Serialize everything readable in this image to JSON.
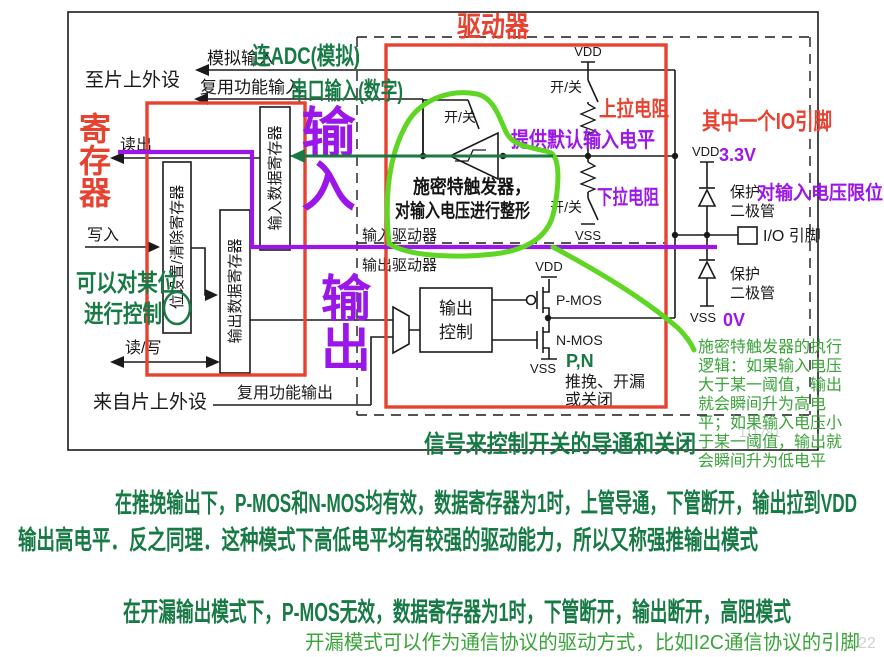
{
  "diagram": {
    "left": {
      "to_chip": "至片上外设",
      "from_chip": "来自片上外设",
      "read": "读出",
      "write": "写入",
      "read_write": "读/写"
    },
    "signals": {
      "analog_in": "模拟输入",
      "af_in": "复用功能输入",
      "af_out": "复用功能输出"
    },
    "registers": {
      "bit_set_clear": "位设置/清除寄存器",
      "output_data": "输出数据寄存器",
      "input_data": "输入数据寄存器"
    },
    "driver": {
      "input_driver": "输入驱动器",
      "output_driver": "输出驱动器",
      "on_off": "开/关",
      "vdd": "VDD",
      "vss": "VSS",
      "output_control_line1": "输出",
      "output_control_line2": "控制",
      "pmos": "P-MOS",
      "nmos": "N-MOS",
      "push_pull": "推挽、开漏",
      "or_off": "或关闭"
    },
    "pin": {
      "protect1": "保护",
      "protect2": "二极管",
      "io_pin": "I/O 引脚"
    }
  },
  "annotations": {
    "red": {
      "register": "寄存器",
      "driver": "驱动器",
      "pull_up": "上拉电阻",
      "io_pin_note": "其中一个IO引脚"
    },
    "purple": {
      "input": "输入",
      "output": "输出",
      "default_level": "提供默认输入电平",
      "pull_down": "下拉电阻",
      "v33": "3.3V",
      "v0": "0V",
      "clamp": "对输入电压限位"
    },
    "green_hand": {
      "adc": "连ADC(模拟)",
      "serial": "串口输入(数字)",
      "bit_ctrl_1": "可以对某位",
      "bit_ctrl_2": "进行控制",
      "switch_note": "信号来控制开关的导通和关闭",
      "pn": "P,N",
      "para1_line1": "在推挽输出下，P-MOS和N-MOS均有效，数据寄存器为1时，上管导通，下管断开，输出拉到VDD",
      "para1_line2": "输出高电平．反之同理．这种模式下高低电平均有较强的驱动能力，所以又称强推输出模式",
      "para2": "在开漏输出模式下，P-MOS无效，数据寄存器为1时，下管断开，输出断开，高阻模式"
    },
    "black_hand": {
      "schmitt_1": "施密特触发器，",
      "schmitt_2": "对输入电压进行整形"
    },
    "typed_green": {
      "schmitt_lines": [
        "施密特触发器的执行",
        "逻辑：如果输入电压",
        "大于某一阈值，输出",
        "就会瞬间升为高电",
        "平；如果输入电压小",
        "于某一阈值，输出就",
        "会瞬间升为低电平"
      ],
      "open_drain": "开漏模式可以作为通信协议的驱动方式，比如I2C通信协议的引脚"
    },
    "watermark": {
      "mid": "111781",
      "tail": "22"
    }
  },
  "colors": {
    "red": "#e74230",
    "purple": "#9b16e8",
    "bright_green": "#5fd524",
    "dark_green": "#177a45",
    "typed_green": "#3aa33a",
    "line_black": "#1a1a1a"
  }
}
